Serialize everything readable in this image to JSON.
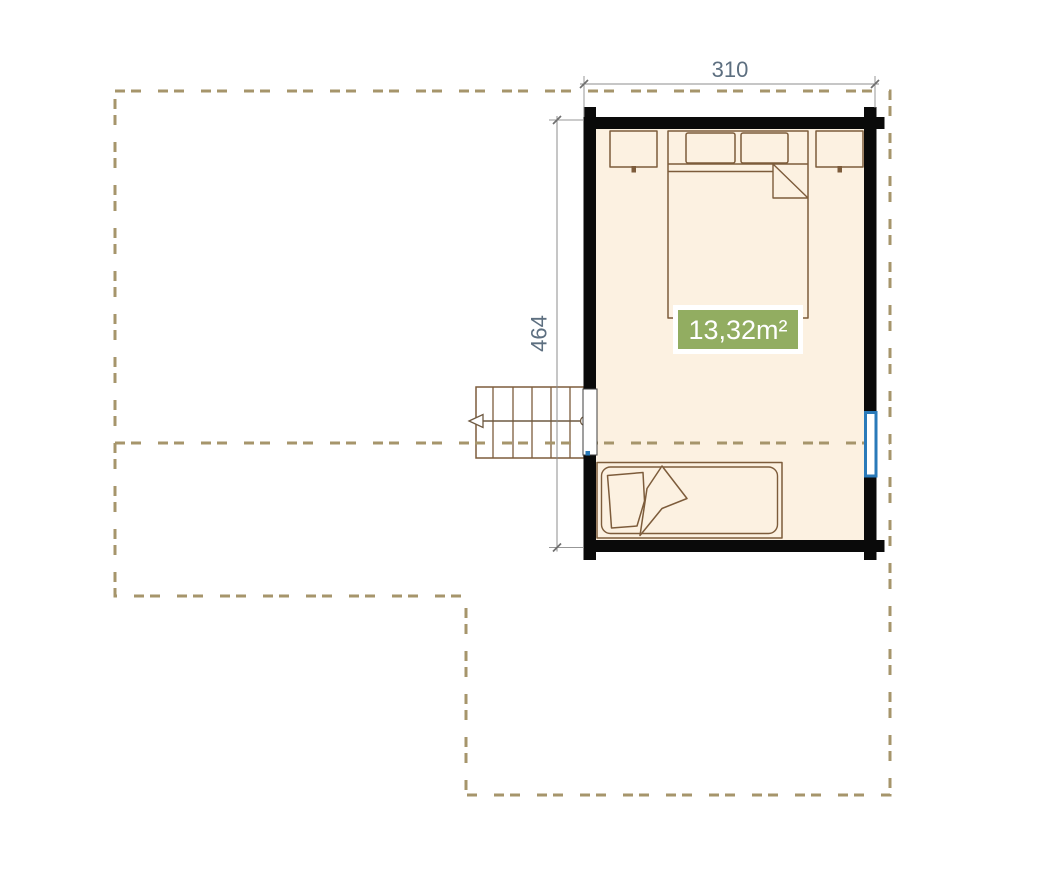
{
  "plan": {
    "dimension_width_label": "310",
    "dimension_height_label": "464",
    "area_label": "13,32m²"
  },
  "colors": {
    "background": "#ffffff",
    "wall": "#0a0a0a",
    "floor": "#fcf1e1",
    "furniture_outline": "#7d5c3b",
    "dashed_outline": "#a6956b",
    "dimension_line": "#8c8c8c",
    "dimension_text": "#5d6f80",
    "area_badge_green": "#92ad61",
    "area_badge_text": "#ffffff",
    "window_blue": "#2a7ab9",
    "stair_arrow": "#6f5a42"
  }
}
